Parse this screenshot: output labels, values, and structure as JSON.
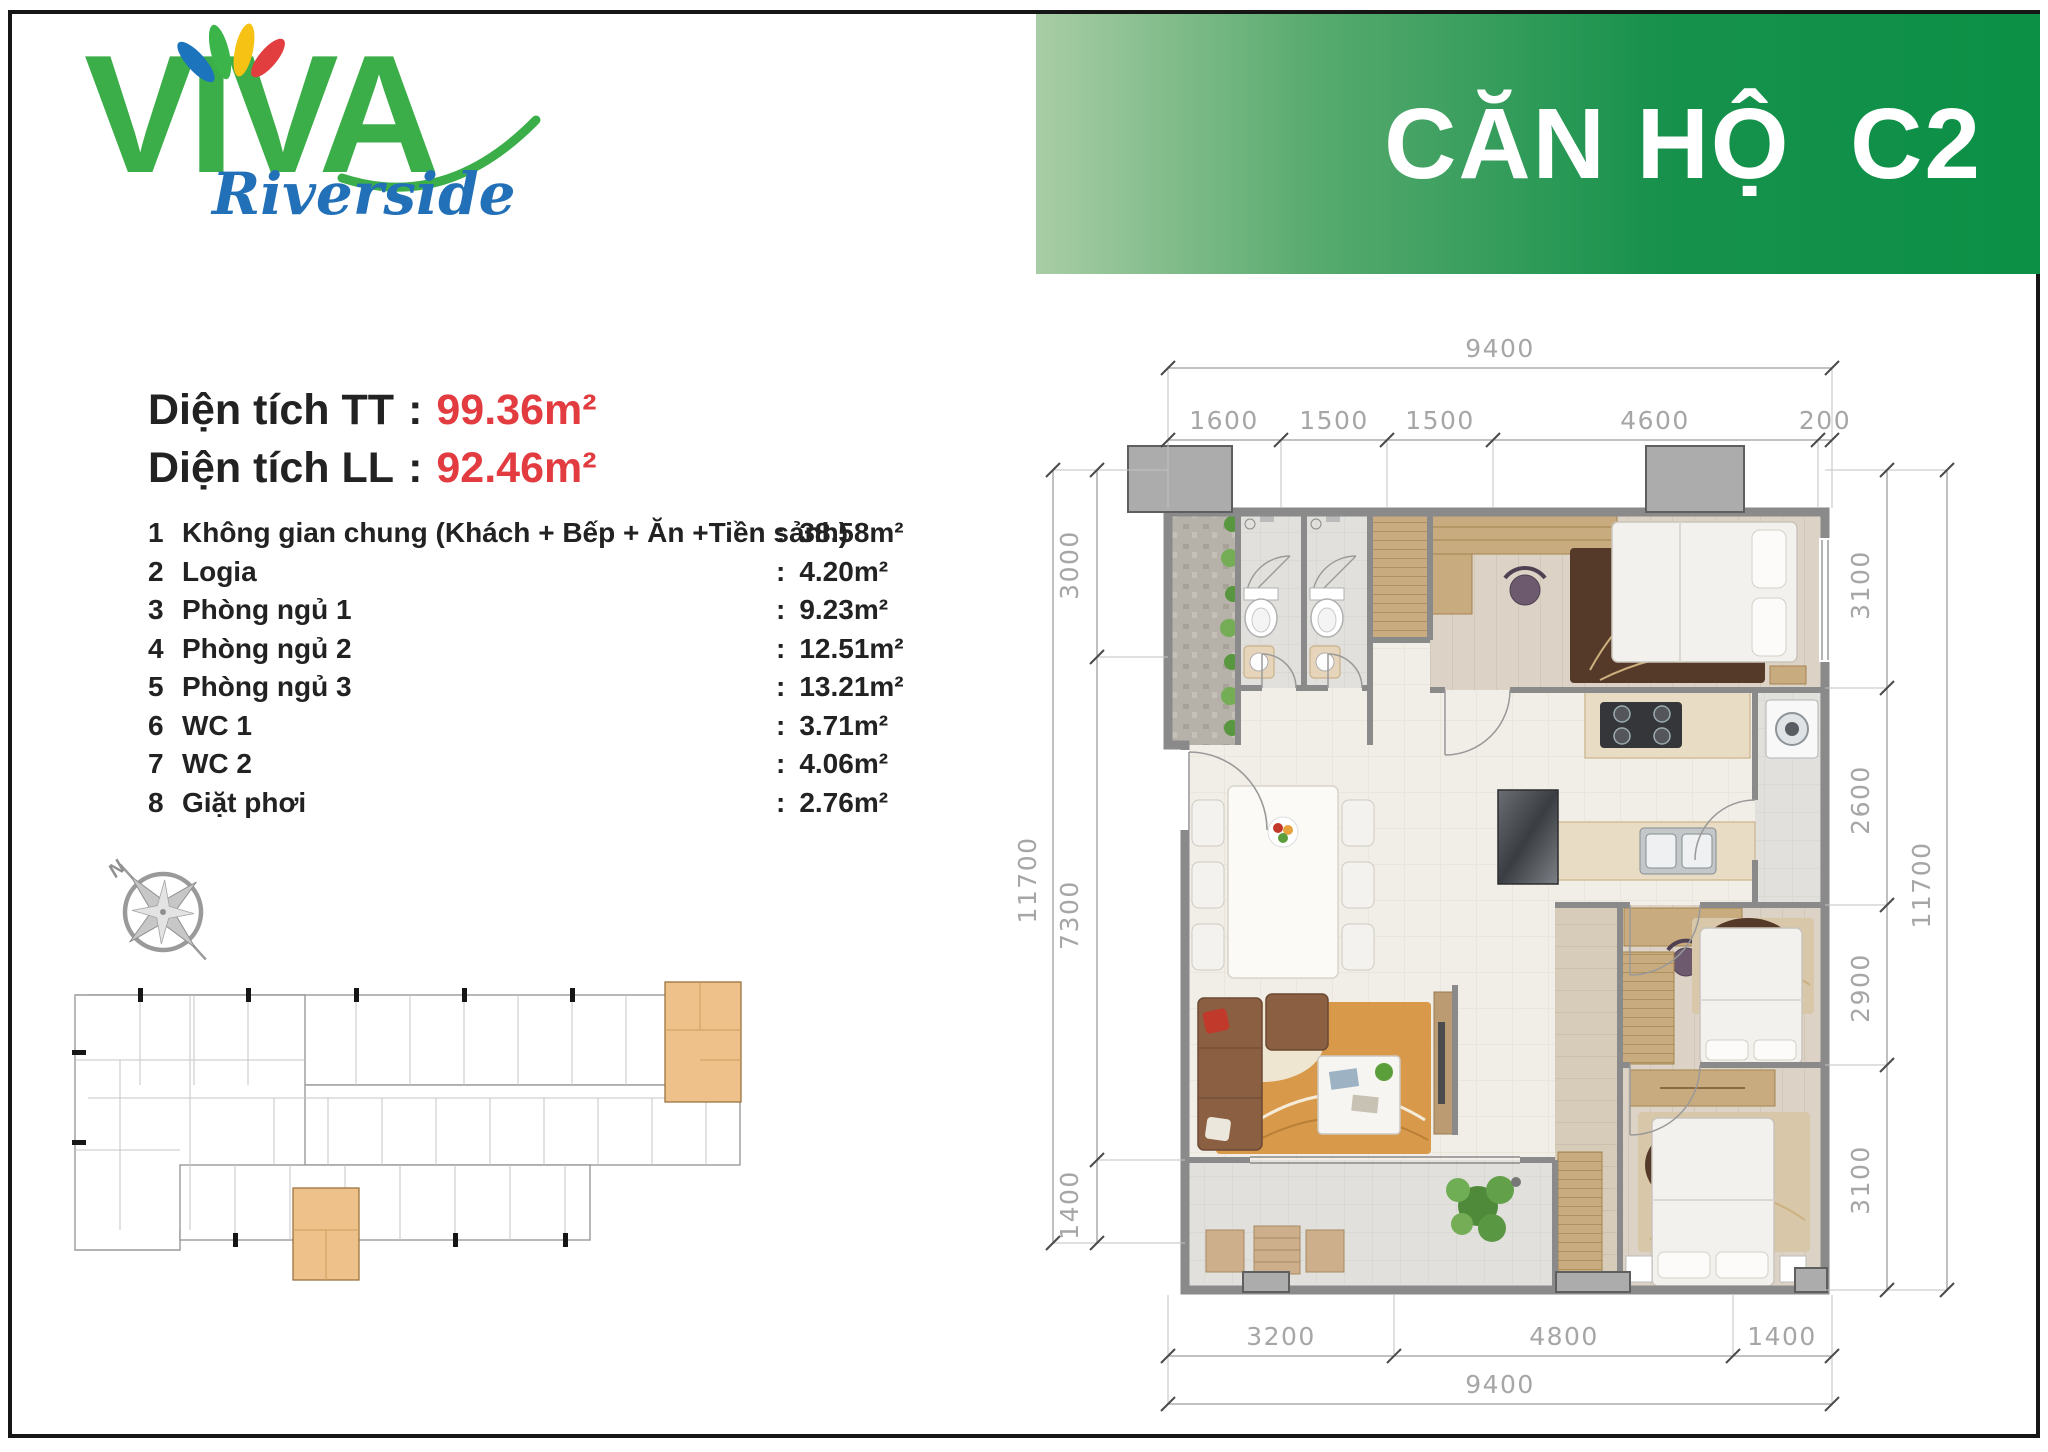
{
  "logo": {
    "brand": "VIVA",
    "sub": "Riverside"
  },
  "banner": {
    "title": "CĂN HỘ  C2"
  },
  "areas": {
    "colon": ":",
    "items": [
      {
        "label": "Diện tích TT",
        "value": "99.36m²"
      },
      {
        "label": "Diện tích LL",
        "value": "92.46m²"
      }
    ]
  },
  "list": {
    "colon": ":",
    "items": [
      {
        "num": "1",
        "label": "Không gian chung (Khách + Bếp + Ăn +Tiền sảnh)",
        "value": "38.58m²"
      },
      {
        "num": "2",
        "label": "Logia",
        "value": "4.20m²"
      },
      {
        "num": "3",
        "label": "Phòng ngủ 1",
        "value": "9.23m²"
      },
      {
        "num": "4",
        "label": "Phòng ngủ 2",
        "value": "12.51m²"
      },
      {
        "num": "5",
        "label": "Phòng ngủ 3",
        "value": "13.21m²"
      },
      {
        "num": "6",
        "label": "WC 1",
        "value": "3.71m²"
      },
      {
        "num": "7",
        "label": "WC 2",
        "value": "4.06m²"
      },
      {
        "num": "8",
        "label": "Giặt phơi",
        "value": "2.76m²"
      }
    ]
  },
  "compass": {
    "north": "N"
  },
  "dims": {
    "top_total": "9400",
    "top_segments": [
      "1600",
      "1500",
      "1500",
      "4600",
      "200"
    ],
    "left_outer": "11700",
    "left_segments": [
      "3000",
      "7300",
      "1400"
    ],
    "right_outer": "11700",
    "right_segments": [
      "3100",
      "2600",
      "2900",
      "3100"
    ],
    "bottom_segments": [
      "3200",
      "4800",
      "1400"
    ],
    "bottom_total": "9400"
  },
  "colors": {
    "accent_green": "#0b9046",
    "logo_green": "#3cae49",
    "value_red": "#e23c41"
  }
}
